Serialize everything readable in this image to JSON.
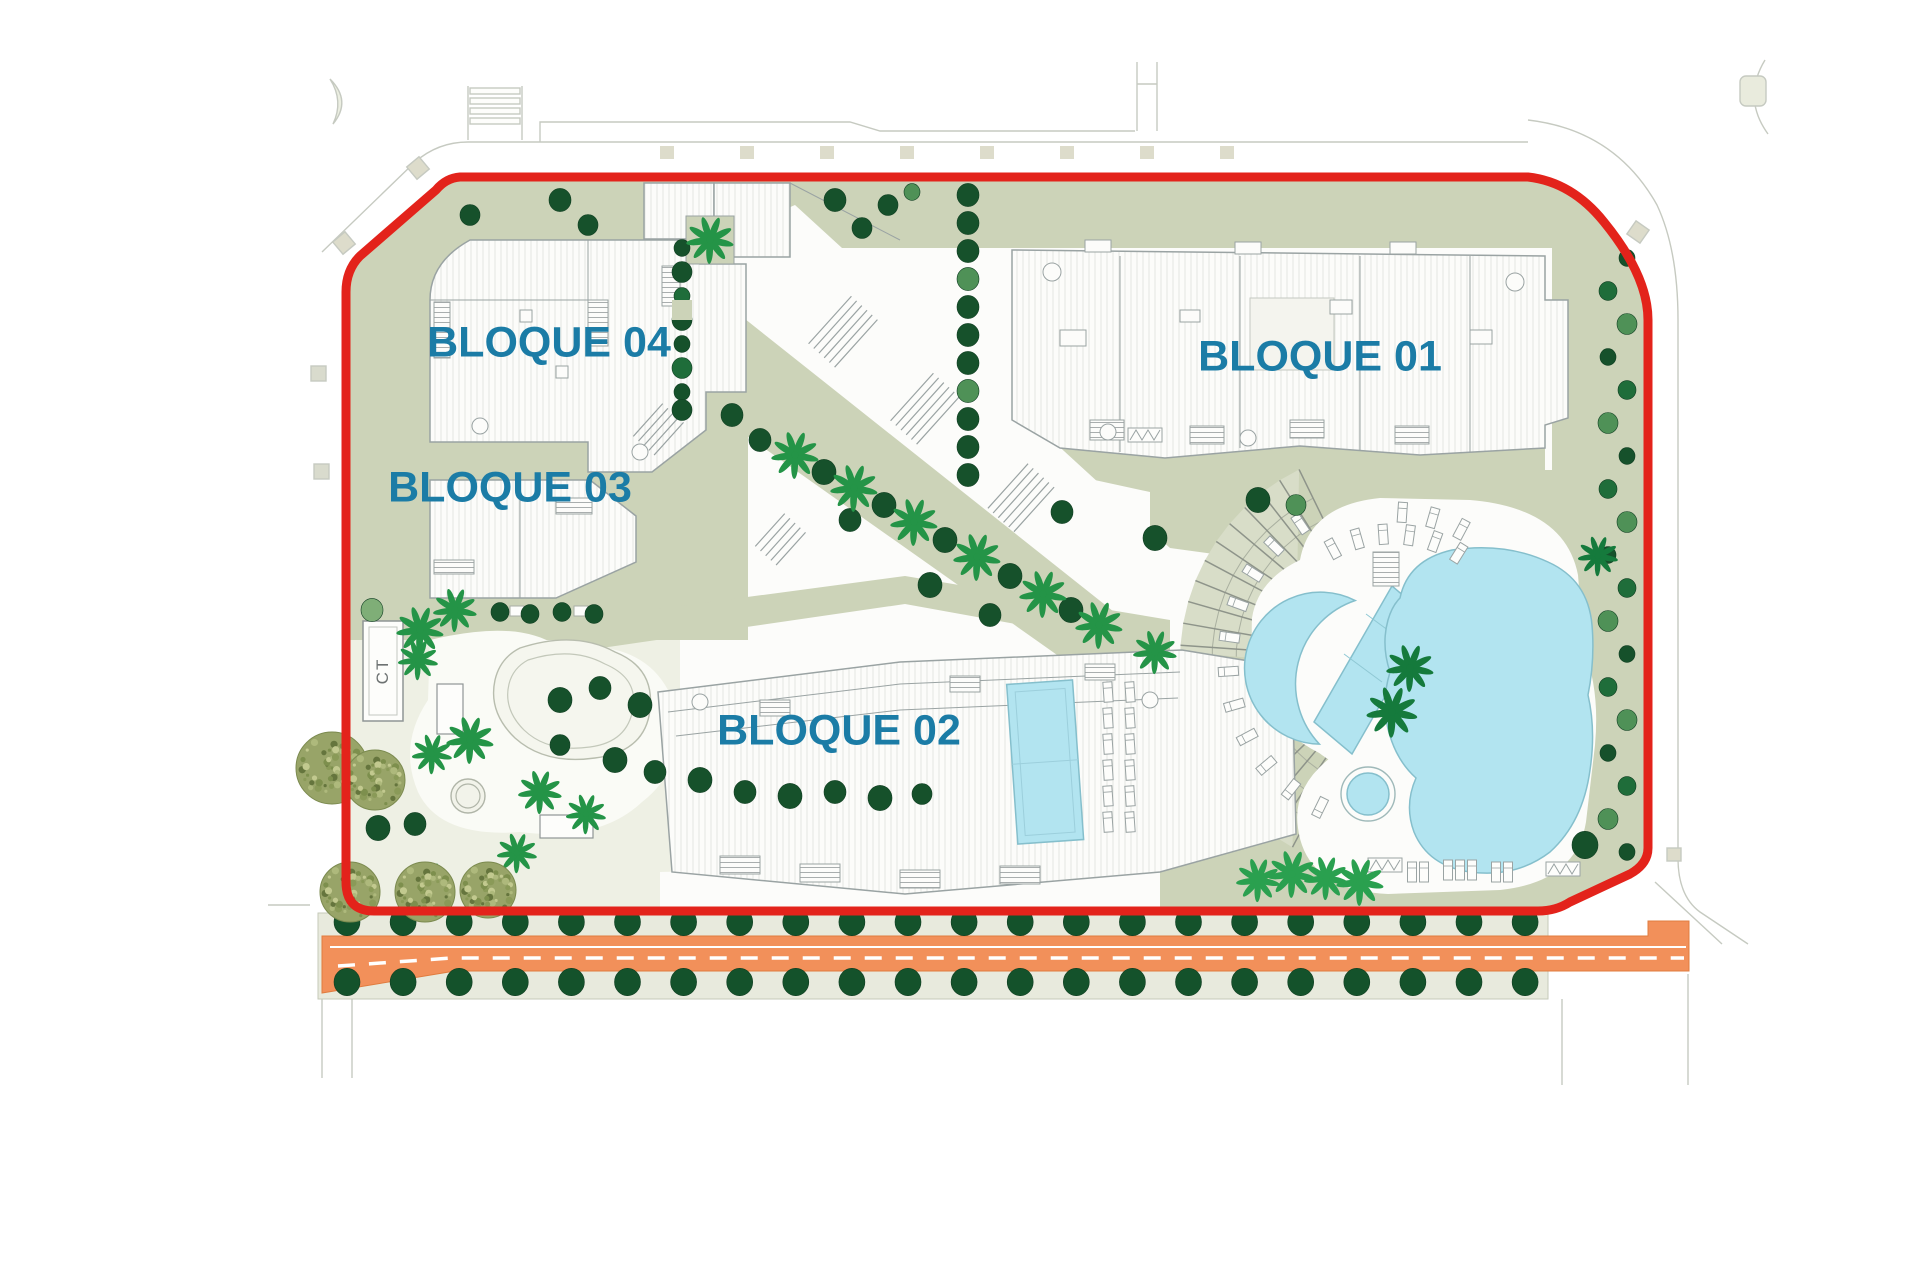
{
  "site": {
    "title": "residential-masterplan",
    "blocks": [
      {
        "id": "bloque-01",
        "label": "BLOQUE 01"
      },
      {
        "id": "bloque-02",
        "label": "BLOQUE 02"
      },
      {
        "id": "bloque-03",
        "label": "BLOQUE 03"
      },
      {
        "id": "bloque-04",
        "label": "BLOQUE 04"
      }
    ],
    "ct_label": "CT",
    "colors": {
      "boundary": "#e3231b",
      "label_text": "#1b7ca6",
      "lawn": "#ccd3b8",
      "lawn_light": "#dfe3d0",
      "garden_pale": "#eef0e4",
      "band": "#d8ddc8",
      "pool": "#b2e4f0",
      "road": "#f2905a",
      "tree_dark": "#16512b",
      "tree_medium": "#1f6d3a",
      "tree_light": "#4f9157",
      "palm_green": "#249447",
      "olive": "#98a468"
    }
  }
}
